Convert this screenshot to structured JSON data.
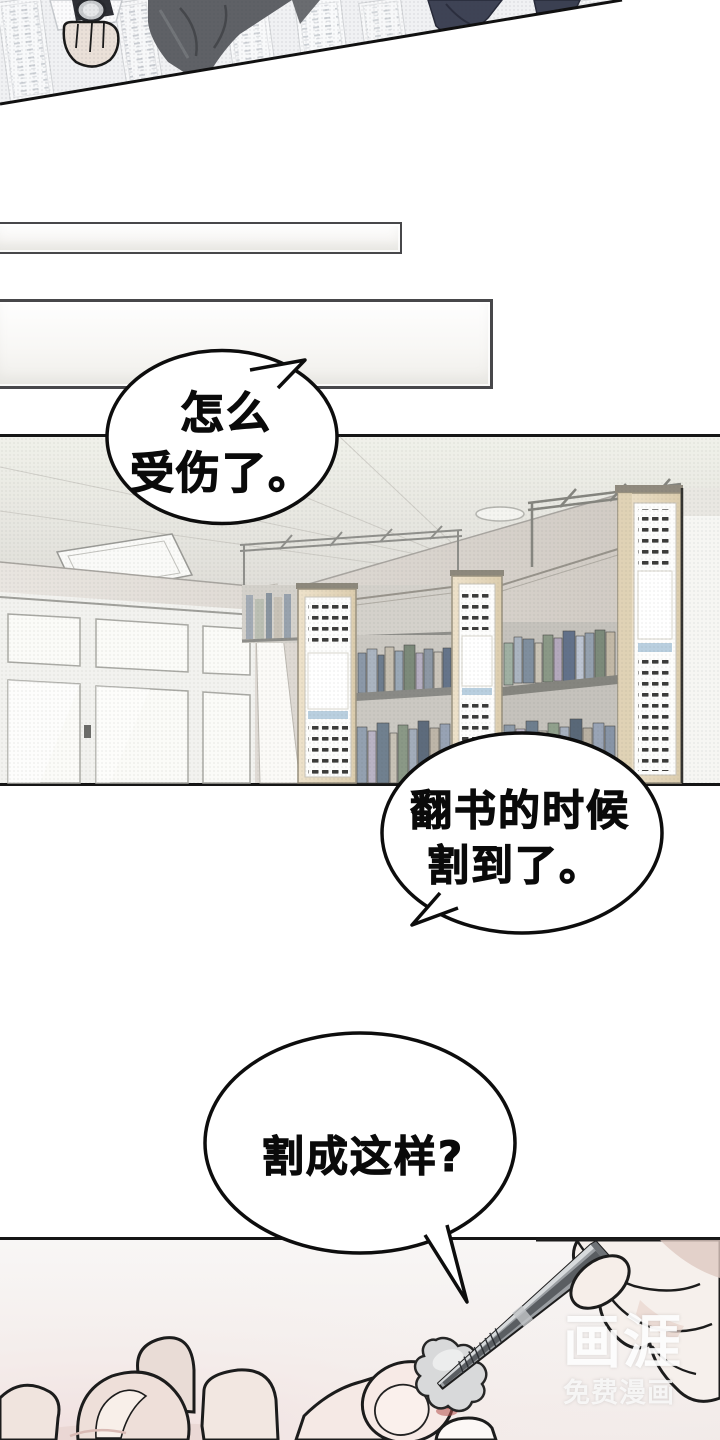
{
  "page": {
    "width": 720,
    "height": 1440,
    "background": "#ffffff"
  },
  "bubbles": {
    "bubble1": {
      "lines": [
        "怎么",
        "受伤了。"
      ]
    },
    "bubble2": {
      "lines": [
        "翻书的时候",
        "割到了。"
      ]
    },
    "bubble3": {
      "lines": [
        "割成这样?"
      ]
    }
  },
  "watermark": {
    "logo": "画涯",
    "tagline": "免费漫画"
  },
  "colors": {
    "panel_border": "#161616",
    "bubble_fill": "#ffffff",
    "bubble_stroke": "#0d0d0d",
    "text": "#0a0a0a",
    "shelf_wood": "#e8dcc2",
    "label_slot": "#3c3c3a",
    "blue_strip": "#b9cfdf",
    "blood": "#a8423f",
    "tool_metal": "#9b9fa3",
    "skin": "#f5e9e5",
    "watermark_white": "rgba(255,255,255,0.92)"
  }
}
